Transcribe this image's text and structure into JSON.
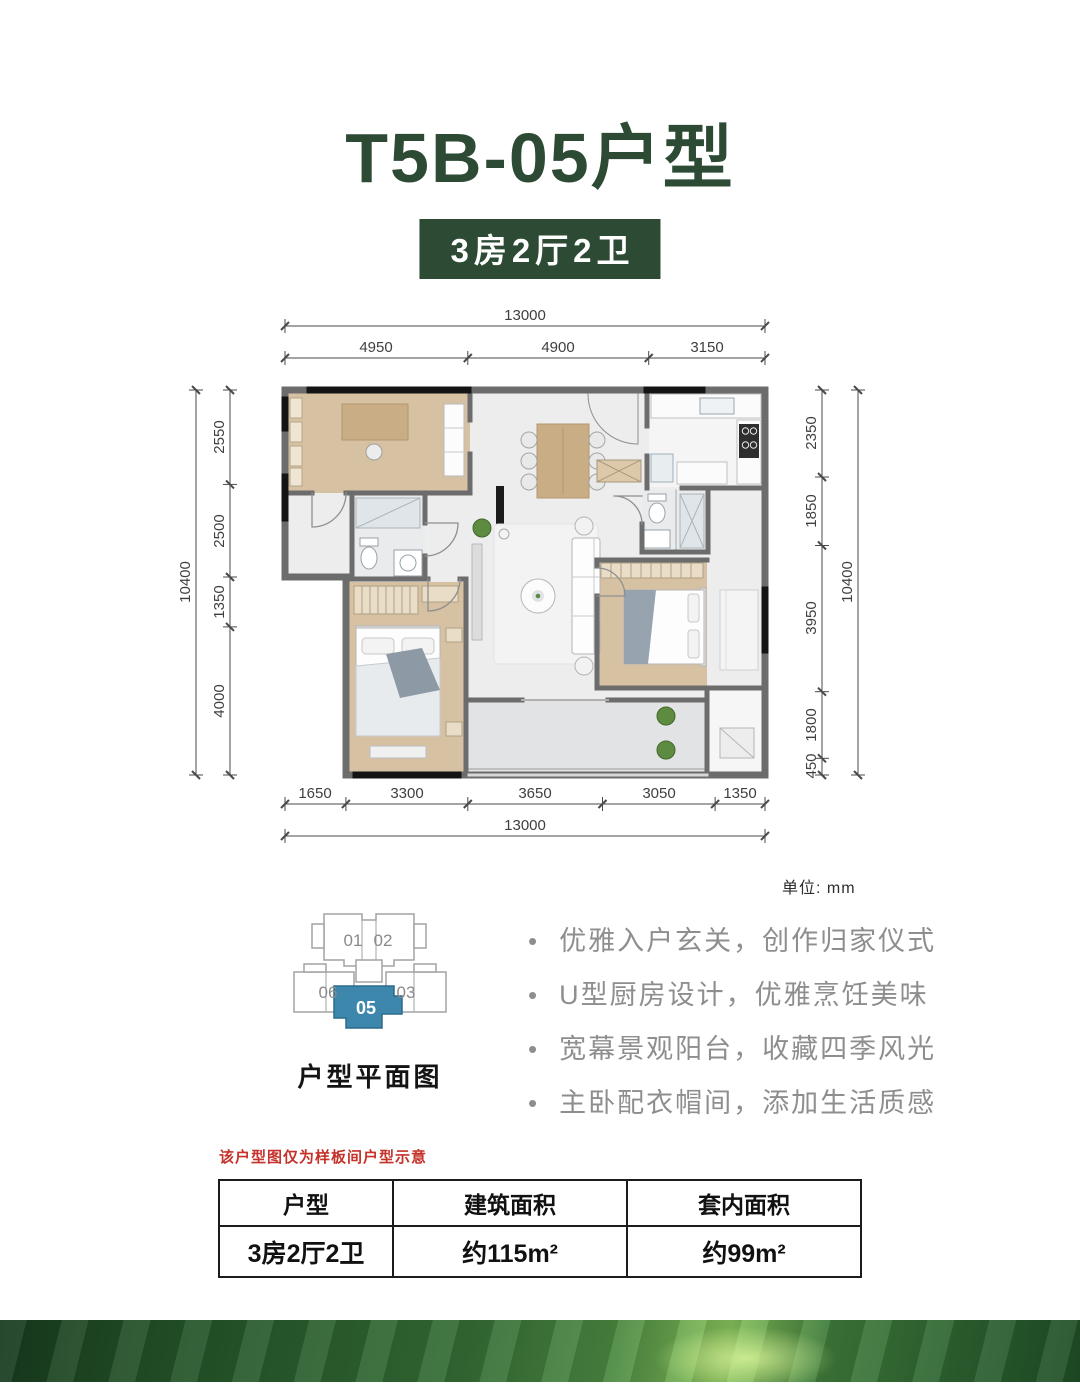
{
  "title": "T5B-05户型",
  "badge": "3房2厅2卫",
  "unit_label": "单位: mm",
  "dims": {
    "top_total": "13000",
    "top_segments": [
      "4950",
      "4900",
      "3150"
    ],
    "bottom_segments": [
      "1650",
      "3300",
      "3650",
      "3050",
      "1350"
    ],
    "bottom_total": "13000",
    "left_total": "10400",
    "left_segments": [
      "2550",
      "2500",
      "1350",
      "4000"
    ],
    "right_segments": [
      "2350",
      "1850",
      "3950",
      "1800",
      "450"
    ],
    "right_total": "10400"
  },
  "keyplan": {
    "caption": "户型平面图",
    "u01": "01",
    "u02": "02",
    "u03": "03",
    "u05": "05",
    "u06": "06",
    "highlight_color": "#3d87ac"
  },
  "features": [
    "优雅入户玄关，创作归家仪式",
    "U型厨房设计，优雅烹饪美味",
    "宽幕景观阳台，收藏四季风光",
    "主卧配衣帽间，添加生活质感"
  ],
  "disclaimer": "该户型图仅为样板间户型示意",
  "spec_table": {
    "headers": [
      "户型",
      "建筑面积",
      "套内面积"
    ],
    "row": [
      "3房2厅2卫",
      "约115m²",
      "约99m²"
    ]
  },
  "colors": {
    "brand_green": "#2c4a34",
    "highlight_blue": "#3d87ac",
    "wood": "#d7c1a3",
    "disclaimer_red": "#c5322a"
  }
}
